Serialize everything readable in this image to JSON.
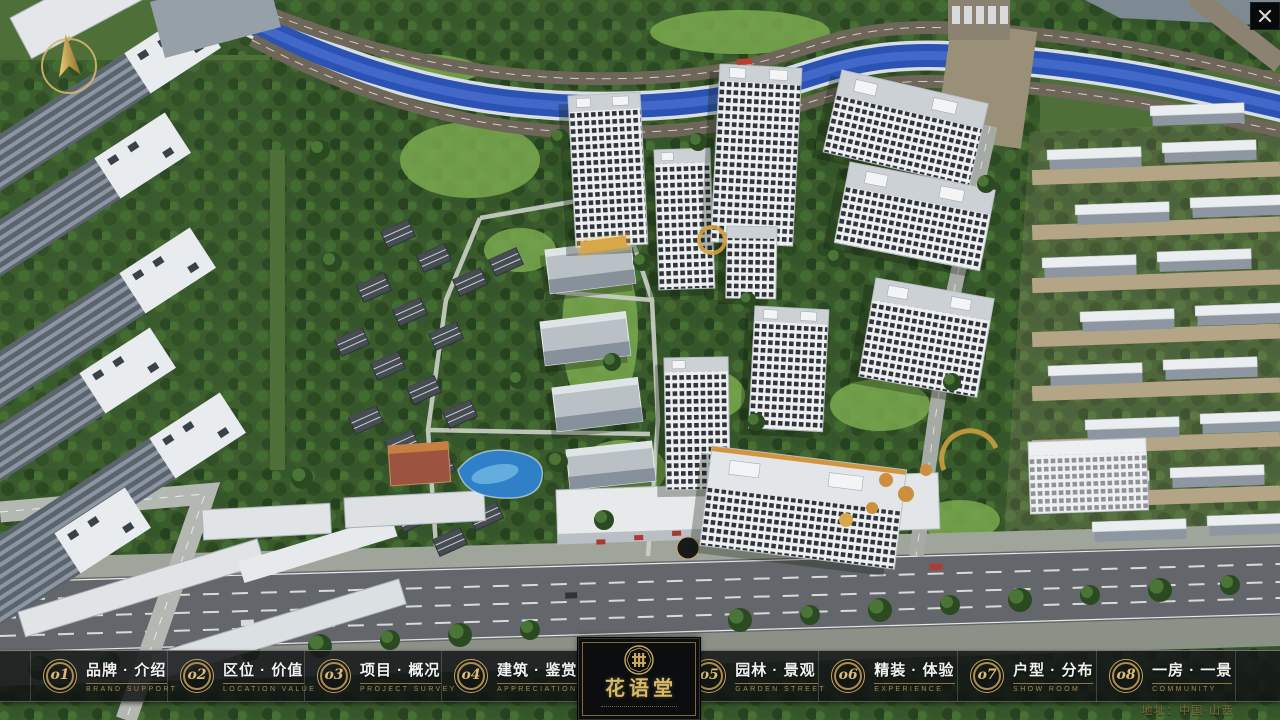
{
  "project": {
    "name": "花语堂",
    "address": "地址：中国·山西"
  },
  "nav": {
    "items": [
      {
        "num": "o1",
        "label_zh": "品牌 · 介绍",
        "label_en": "BRAND SUPPORT"
      },
      {
        "num": "o2",
        "label_zh": "区位 · 价值",
        "label_en": "LOCATION VALUE"
      },
      {
        "num": "o3",
        "label_zh": "项目 · 概况",
        "label_en": "PROJECT SURVEY"
      },
      {
        "num": "o4",
        "label_zh": "建筑 · 鉴赏",
        "label_en": "APPRECIATION"
      },
      {
        "num": "o5",
        "label_zh": "园林 · 景观",
        "label_en": "GARDEN STREET"
      },
      {
        "num": "o6",
        "label_zh": "精装 · 体验",
        "label_en": "EXPERIENCE"
      },
      {
        "num": "o7",
        "label_zh": "户型 · 分布",
        "label_en": "SHOW ROOM"
      },
      {
        "num": "o8",
        "label_zh": "一房 · 一景",
        "label_en": "COMMUNITY"
      }
    ]
  },
  "colors": {
    "accent_gold": "#c9a355",
    "bar_background": "rgba(16,18,20,0.85)",
    "river_blue": "#2b53b4"
  }
}
